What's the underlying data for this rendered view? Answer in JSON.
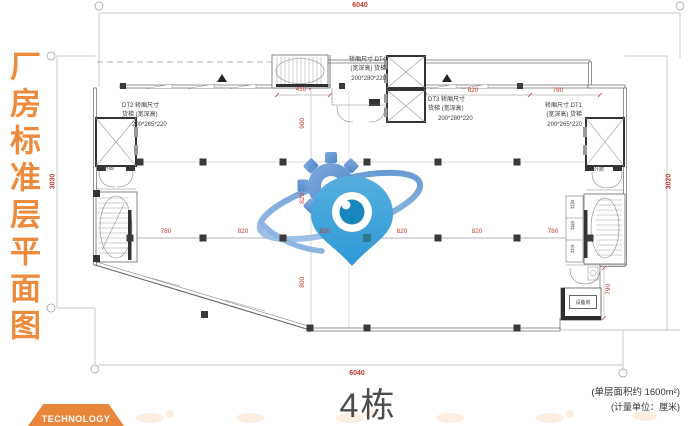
{
  "title": {
    "vertical_text": "厂房标准层平面图"
  },
  "banner": {
    "label": "TECHNOLOGY"
  },
  "footer": {
    "building": "4栋",
    "area_note": "(单层面积约 1600m²)",
    "unit_note": "(计量单位：厘米)"
  },
  "dims": {
    "top_total": "6040",
    "bottom_total": "6040",
    "left_total": "3030",
    "right_total": "3020",
    "top_sub": [
      "410",
      "620",
      "780"
    ],
    "mid": [
      "780",
      "820",
      "820",
      "820",
      "820",
      "780"
    ],
    "left_sub": [
      "900",
      "820",
      "800"
    ],
    "right_sub": "790"
  },
  "elevators": {
    "dt4": [
      "轿厢尺寸 DT4",
      "(宽深高) 货梯",
      "200*280*220"
    ],
    "dt3": [
      "DT3 轿厢尺寸",
      "货梯 (宽深高)",
      "200*280*220"
    ],
    "dt2": [
      "DT2 轿厢尺寸",
      "货梯 (宽深高)",
      "200*265*220"
    ],
    "dt1": [
      "轿厢尺寸 DT1",
      "(宽深高) 货梯",
      "200*265*220"
    ]
  },
  "rooms": {
    "corridor_left": "外廊",
    "corridor_right": "外廊",
    "equipment": "设备房",
    "shafts": [
      "风井",
      "电井",
      "水井"
    ]
  },
  "colors": {
    "accent_orange": "#E8873B",
    "dim_red": "#C23B2E",
    "logo_blue": "#3F94D6",
    "logo_blue_dark": "#1A86C0",
    "wall_gray": "#4f4f4f"
  }
}
